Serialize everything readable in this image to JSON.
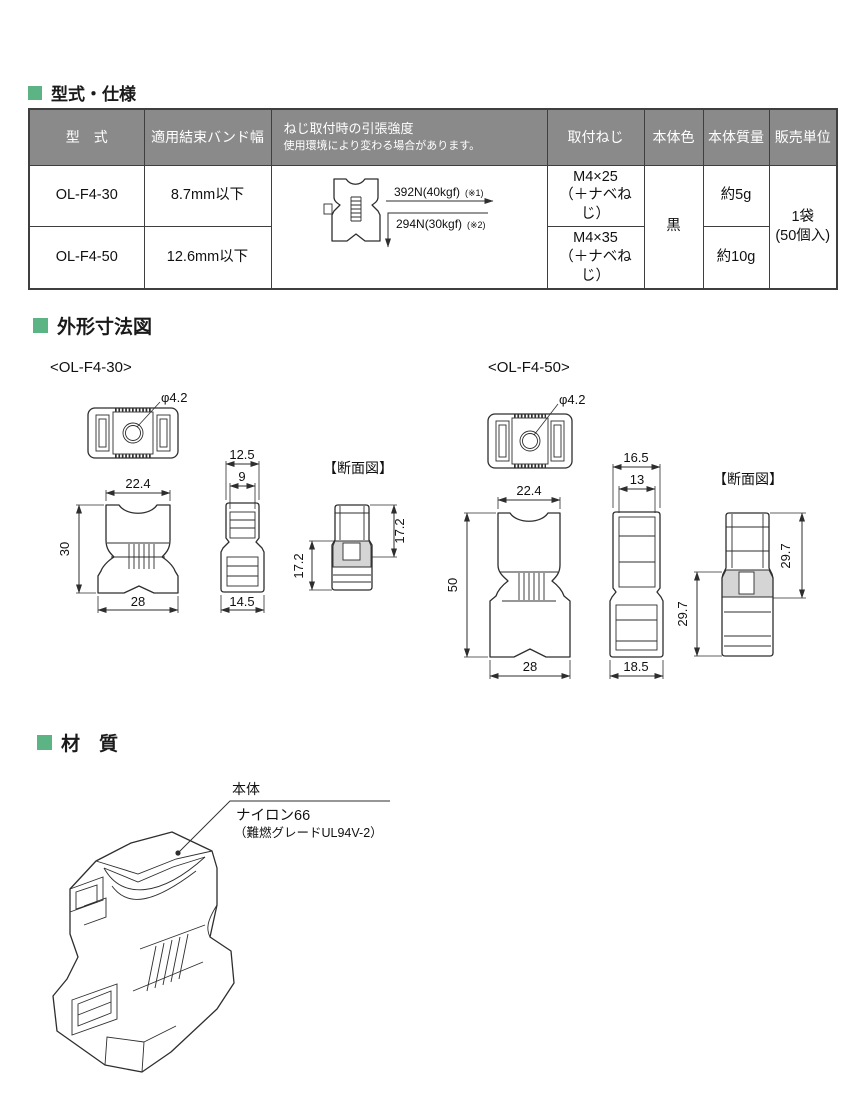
{
  "colors": {
    "accent_green": "#5cb485",
    "table_header_bg": "#8a8a8a",
    "table_header_text": "#ffffff",
    "drawing_line": "#2e2e2e",
    "section_shade": "#d5d5d5"
  },
  "sections": {
    "spec": {
      "heading": "型式・仕様"
    },
    "dims": {
      "heading": "外形寸法図"
    },
    "material": {
      "heading": "材　質"
    }
  },
  "spec_table": {
    "headers": {
      "model": "型　式",
      "band_width": "適用結束バンド幅",
      "tensile_line1": "ねじ取付時の引張強度",
      "tensile_line2": "使用環境により変わる場合があります。",
      "screw": "取付ねじ",
      "body_color": "本体色",
      "body_mass": "本体質量",
      "sales_unit": "販売単位"
    },
    "rows": [
      {
        "model": "OL-F4-30",
        "band_width": "8.7mm以下",
        "screw_line1": "M4×25",
        "screw_line2": "（＋ナベねじ）",
        "mass": "約5g"
      },
      {
        "model": "OL-F4-50",
        "band_width": "12.6mm以下",
        "screw_line1": "M4×35",
        "screw_line2": "（＋ナベねじ）",
        "mass": "約10g"
      }
    ],
    "body_color_value": "黒",
    "sales_unit_line1": "1袋",
    "sales_unit_line2": "(50個入)",
    "tensile_diagram": {
      "arrow_right_label": "392N(40kgf)",
      "arrow_right_note": "(※1)",
      "arrow_down_label": "294N(30kgf)",
      "arrow_down_note": "(※2)"
    }
  },
  "dim30": {
    "model_label": "<OL-F4-30>",
    "hole_dia": "φ4.2",
    "front_top_width": "22.4",
    "front_height": "30",
    "front_bottom_width": "28",
    "side_top_width": "12.5",
    "side_inner_width": "9",
    "side_bottom_width": "14.5",
    "section_title": "【断面図】",
    "section_upper_height": "17.2",
    "section_lower_height": "17.2"
  },
  "dim50": {
    "model_label": "<OL-F4-50>",
    "hole_dia": "φ4.2",
    "front_top_width": "22.4",
    "front_height": "50",
    "front_bottom_width": "28",
    "side_top_width": "16.5",
    "side_inner_width": "13",
    "side_bottom_width": "18.5",
    "section_title": "【断面図】",
    "section_upper_height": "29.7",
    "section_lower_height": "29.7"
  },
  "material": {
    "part_label": "本体",
    "name": "ナイロン66",
    "grade": "（難燃グレードUL94V-2）"
  }
}
